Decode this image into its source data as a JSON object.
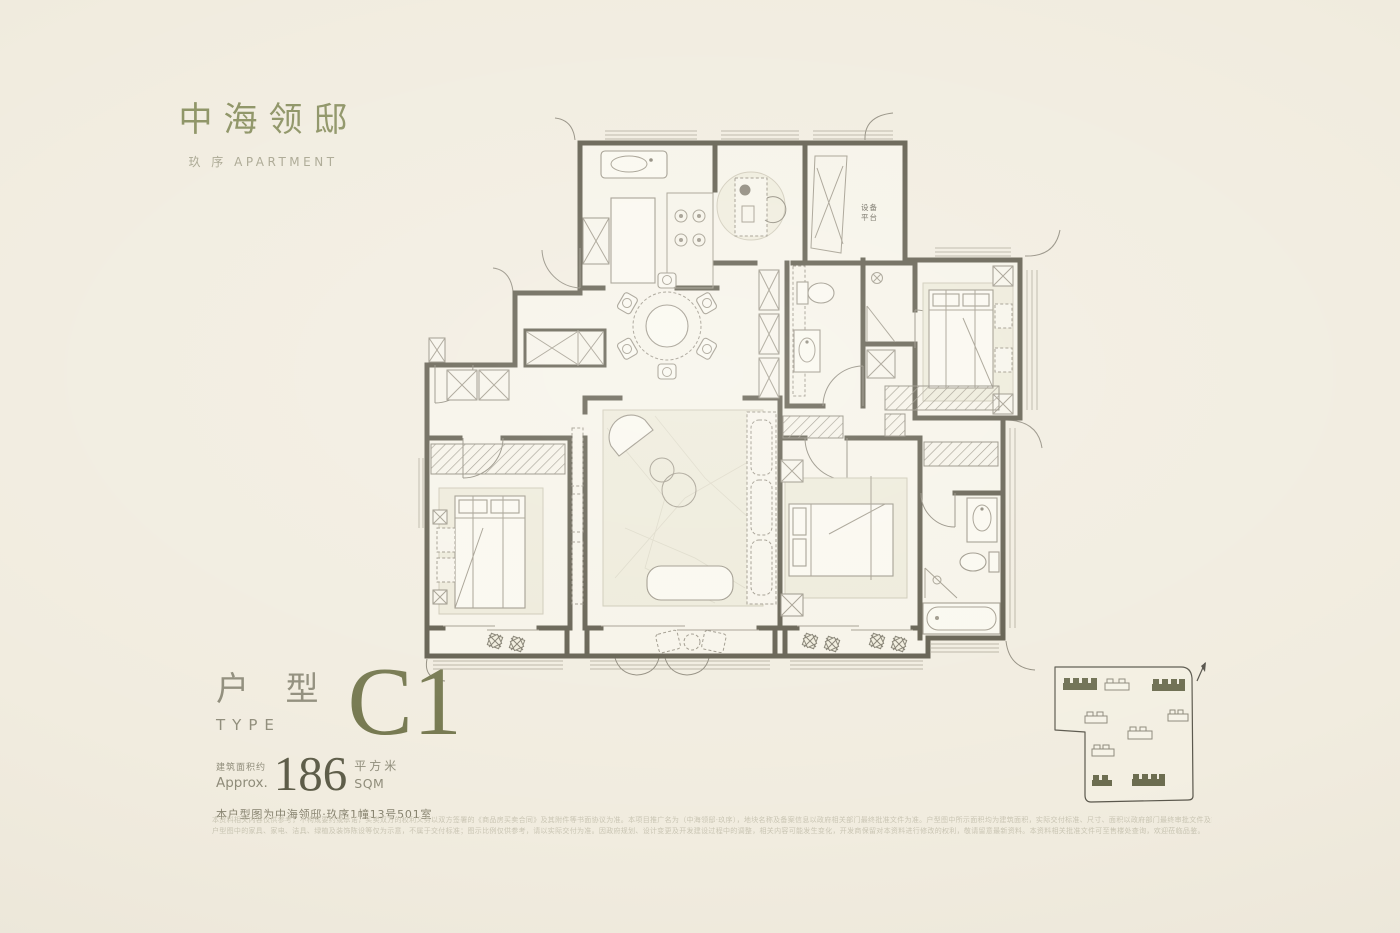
{
  "brand": {
    "logo": "中海领邸",
    "sub_cn": "玖 序",
    "sub_en": "APARTMENT",
    "brand_green": "#8a9060"
  },
  "unit": {
    "type_cn": "户 型",
    "type_en": "TYPE",
    "type_code": "C1",
    "type_green": "#72754b",
    "area_label_cn": "建筑面积约",
    "area_label_en": "Approx.",
    "area_value": "186",
    "area_unit_cn": "平方米",
    "area_unit_en": "SQM",
    "location": "本户型图为中海领邸·玖序1幢13号501室"
  },
  "floorplan": {
    "equipment_line1": "设备",
    "equipment_line2": "平台",
    "wall_color": "#5d5949",
    "rooms": [
      "厨房 kitchen",
      "餐厅 dining",
      "设备平台 equipment platform",
      "客厅 living room",
      "卧室×3 bedrooms",
      "卫生间×2 bathrooms",
      "阳台×3 balconies",
      "步入式衣帽间 walk-in closet"
    ]
  },
  "siteplan": {
    "buildings_filled": 4,
    "buildings_outlined": 5,
    "building_fill": "#6c6d50",
    "north_arrow": "north"
  },
  "disclaimer": {
    "line1": "本资料相关内容仅供参考，不构成要约或承诺，买卖双方的权利义务以双方签署的《商品房买卖合同》及其附件等书面协议为准。本项目推广名为（中海领邸·玖序），地块名称及备案信息以政府相关部门最终批准文件为准。户型图中所示面积均为建筑面积，实际交付标准、尺寸、面积以政府部门最终审批文件及商品房买卖合同约定为准。",
    "line2": "户型图中的家具、家电、洁具、绿植及装饰陈设等仅为示意，不属于交付标准；图示比例仅供参考，请以实际交付为准。因政府规划、设计变更及开发建设过程中的调整，相关内容可能发生变化，开发商保留对本资料进行修改的权利，敬请留意最新资料。本资料相关批准文件可至售楼处查询，欢迎莅临品鉴。"
  },
  "page": {
    "background": "#f1ecdf"
  }
}
